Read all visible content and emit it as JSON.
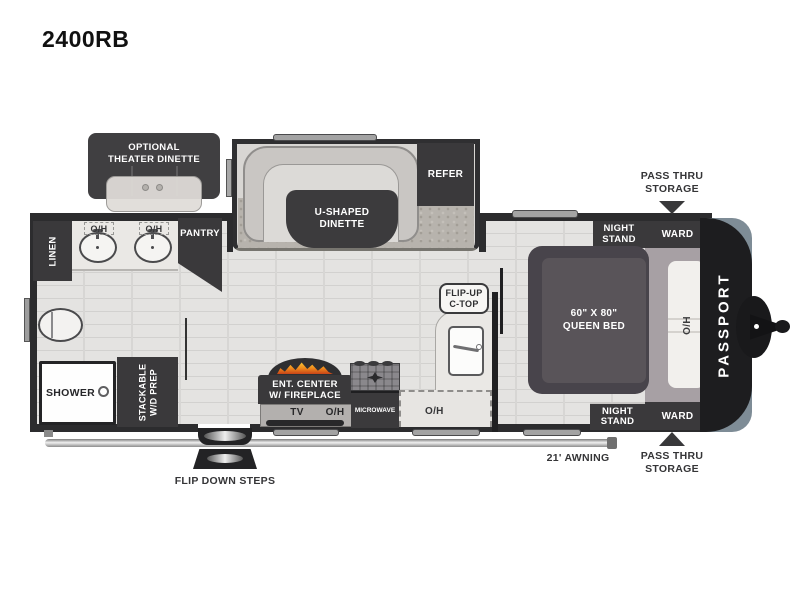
{
  "title": "2400RB",
  "brand": "PASSPORT",
  "colors": {
    "wall": "#2c2c2e",
    "cabinet": "#3a393b",
    "floor": "#e4e3e1",
    "carpet": "#b7b3ad",
    "front_cap_accent": "#7e8c96",
    "flame": "#ef8b1c"
  },
  "living": {
    "theater": [
      "OPTIONAL",
      "THEATER DINETTE"
    ],
    "dinette": [
      "U-SHAPED",
      "DINETTE"
    ],
    "refer": "REFER",
    "pantry": "PANTRY"
  },
  "bath": {
    "linen": "LINEN",
    "oh_left": "O/H",
    "oh_right": "O/H",
    "shower": "SHOWER",
    "stackable": [
      "STACKABLE",
      "W/D PREP"
    ]
  },
  "kitchen": {
    "ent_center": [
      "ENT. CENTER",
      "W/ FIREPLACE"
    ],
    "tv": "TV",
    "oh_tv": "O/H",
    "microwave": "MICROWAVE",
    "flip_up": [
      "FLIP-UP",
      "C-TOP"
    ],
    "oh_counter": "O/H"
  },
  "bedroom": {
    "night_stand": [
      "NIGHT",
      "STAND"
    ],
    "ward": "WARD",
    "bed": [
      "60\" X 80\"",
      "QUEEN BED"
    ],
    "oh_bed": "O/H"
  },
  "exterior": {
    "pass_thru": [
      "PASS THRU",
      "STORAGE"
    ],
    "awning": "21' AWNING",
    "steps": "FLIP DOWN STEPS"
  }
}
